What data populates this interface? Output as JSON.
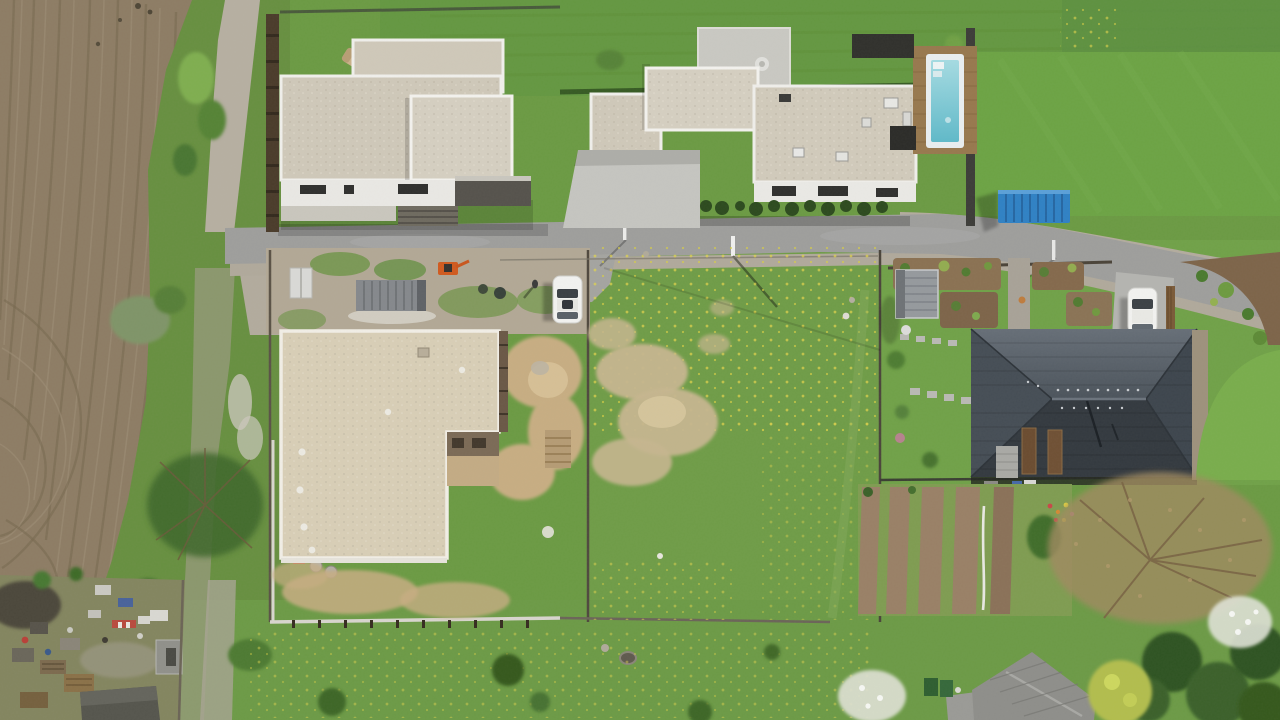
{
  "scene": {
    "type": "aerial-drone-photograph",
    "description": "Top-down drone view of a small suburban development: a plowed field on the left, two modern flat-roof houses along an asphalt street at top, a swimming pool, a blue shipping container, a house under construction with a beige gravel roof, a vacant grassy lot with two white cars, a house with a dark hip roof beside ornamental gardens, vegetable garden rows, and a cluttered junk yard at bottom left."
  },
  "labels": {
    "photo": "aerial drone photo of residential plots",
    "field": "plowed farm field with curved tractor furrows",
    "road": "asphalt street curving to the lower right",
    "gravel_path": "gravel track along the field edge",
    "house_a": "modern flat-roof house (west)",
    "house_b": "modern flat-roof house (east) with terrace",
    "pool": "swimming pool with wooden deck",
    "blue_container": "blue shipping container by the road",
    "construction_site": "fenced construction site",
    "house_d": "house under construction with beige gravel roof",
    "gray_container": "gray site container",
    "porta_potty": "portable toilet cabin",
    "excavator": "orange mini excavator",
    "vacant_lot": "vacant meadow lot with dandelions",
    "car_road": "white car parked at road spur",
    "car_driveway": "white car on driveway",
    "person": "person standing near parked car",
    "hip_house": "house with dark gray hip roof",
    "garden_shed": "small gray garden shed",
    "ornamental_garden": "ornamental garden beds with stepping stones",
    "vegetable_garden": "tilled vegetable garden rows",
    "bare_tree": "large leafless tree",
    "blossom_trees": "white blossoming trees",
    "junk_yard": "cluttered junk yard with sheds and pallets",
    "bottom_building": "gray shingled roof building",
    "lamp_post": "street lamp post",
    "sign_post": "white sign post at junction"
  },
  "palette": {
    "field": "#8d7c64",
    "furrow": "#77684f",
    "furrowLight": "#9f9078",
    "grass": "#6b9a43",
    "grassStrip": "#678f40",
    "topBand": "#649741",
    "lawnBright": "#6ca344",
    "meadow": "#6f9c47",
    "asphalt": "#9e9e9c",
    "gravel": "#b6afa1",
    "concrete": "#c5c5c0",
    "roofGravel": "#cfc8b9",
    "roofGravelTan": "#d8ceb6",
    "parapet": "#f0efeb",
    "whiteWall": "#e9e8e4",
    "hipTop": "#565e66",
    "hipBottom": "#33393f",
    "hipLeft": "#454d55",
    "hipRight": "#3d454d",
    "poolWater": "#7ecbd6",
    "deckWood": "#97784e",
    "containerBlue": "#2f81c4",
    "containerGray": "#85888c",
    "mulch": "#7d6449",
    "tilledSoil": "#998066",
    "sand": "#c7ad82",
    "junkBase": "#83855f",
    "treeDark": "#2f5222",
    "blossom": "#dfe2d6",
    "carWhite": "#f2f2f0"
  }
}
